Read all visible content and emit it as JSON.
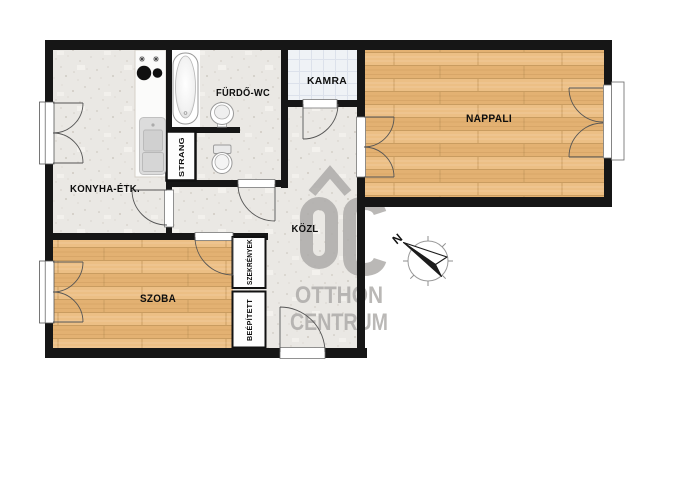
{
  "floorplan": {
    "title": "apartment floor plan",
    "labels": {
      "konyha": "KONYHA-ÉTK.",
      "furdo": "FÜRDŐ-WC",
      "kamra": "KAMRA",
      "nappali": "NAPPALI",
      "kozl": "KÖZL",
      "szoba": "SZOBA",
      "strang": "STRANG",
      "beepitett": "BEÉPÍTETT",
      "szekrenyek": "SZEKRÉNYEK"
    },
    "compass": {
      "north": "N"
    },
    "watermark": {
      "monogram": "OC",
      "line1": "OTTHON",
      "line2": "CENTRUM"
    },
    "colors": {
      "wall": "#161616",
      "concrete_floor": "#eae8e4",
      "wood_floor": "#e8b97a",
      "pantry_tile": "#eff2f6",
      "fixture_white": "#fdfdfd",
      "watermark_gray": "#aeacaa",
      "door_arc": "#555555"
    }
  }
}
